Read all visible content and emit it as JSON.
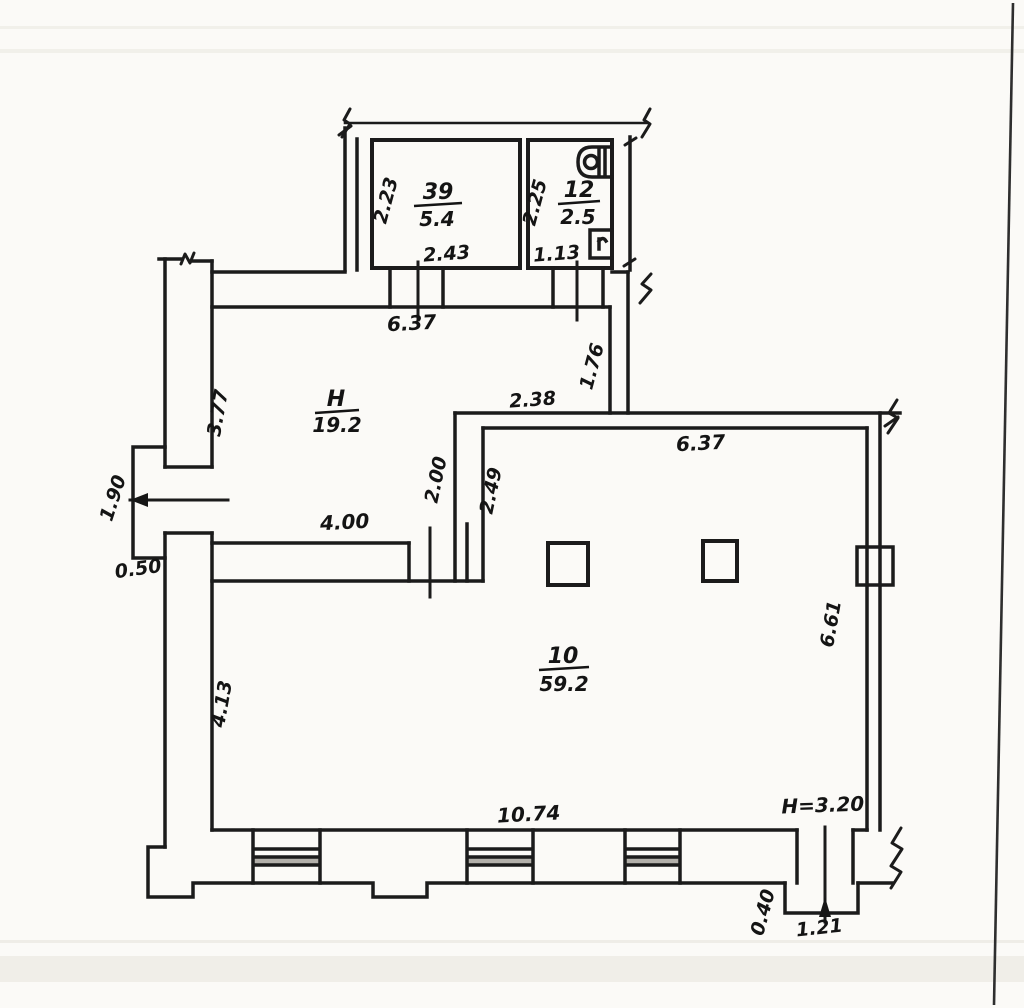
{
  "document": {
    "type": "scanned floor plan drawing"
  },
  "colors": {
    "ink": "#1b1b1b",
    "paper": "#fbfaf7",
    "window_shade": "#b3b0aa"
  },
  "rooms": {
    "room39": {
      "number": "39",
      "area": "5.4"
    },
    "room12": {
      "number": "12",
      "area": "2.5"
    },
    "hall": {
      "number": "H",
      "area": "19.2"
    },
    "room10": {
      "number": "10",
      "area": "59.2"
    }
  },
  "dims": {
    "room39_depth": "2.23",
    "room39_width": "2.43",
    "room12_depth": "2.25",
    "room12_width": "1.13",
    "hall_top_width": "6.37",
    "hall_left_depth": "3.77",
    "corridor_depth": "1.76",
    "mid_wall_width": "2.38",
    "passage_depth": "2.00",
    "room10_upper_depth": "2.49",
    "room10_top_width": "6.37",
    "hall_bottom_width": "4.00",
    "left_entry_width": "1.90",
    "left_porch_depth": "0.50",
    "room10_right_depth": "6.61",
    "room10_left_depth": "4.13",
    "room10_bottom_width": "10.74",
    "ceiling_height": "H=3.20",
    "bottom_porch_depth": "0.40",
    "bottom_entry_width": "1.21"
  }
}
